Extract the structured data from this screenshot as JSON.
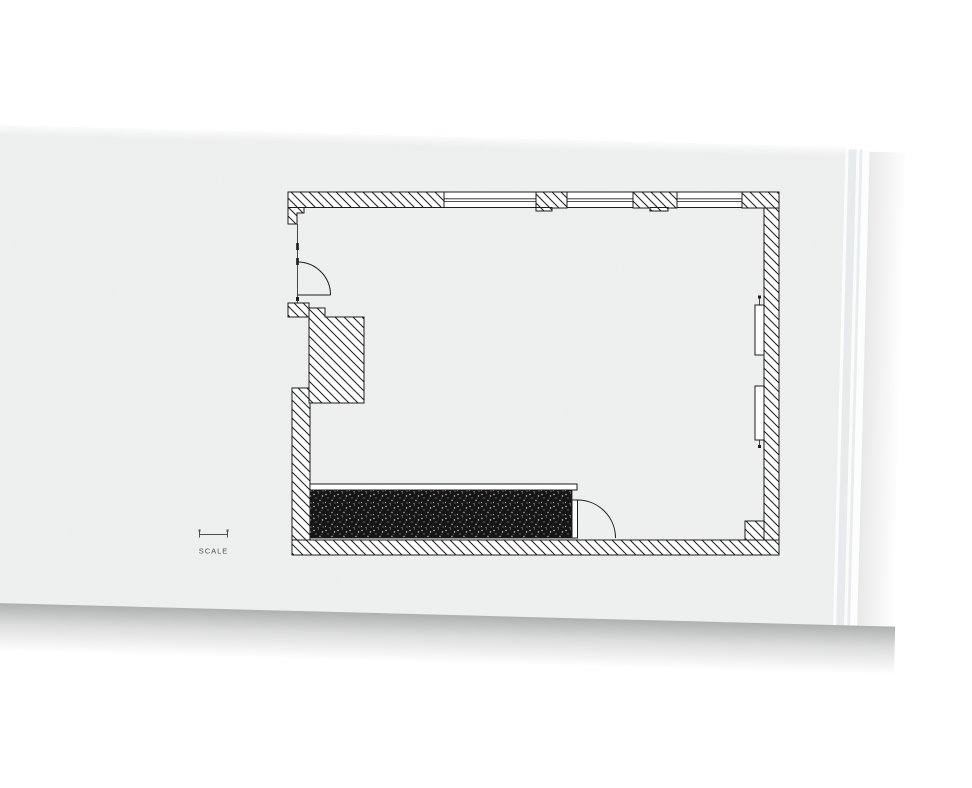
{
  "page": {
    "scale_indicator": {
      "label": "SCALE"
    }
  },
  "plan": {
    "type": "architectural-floor-plan",
    "symbols": [
      "hatched-exterior-walls",
      "window-band-top",
      "entry-door-swing",
      "interior-door-swing",
      "chimney-breast",
      "radiator",
      "counter-with-dark-poche"
    ]
  },
  "colors": {
    "background": "#ffffff",
    "paper": "#f0f1f1",
    "ink": "#1c1c1c",
    "scale_gray": "#4f4f4f",
    "edge_strip": "#e8ebed",
    "edge_strip_2": "#eaedef"
  }
}
